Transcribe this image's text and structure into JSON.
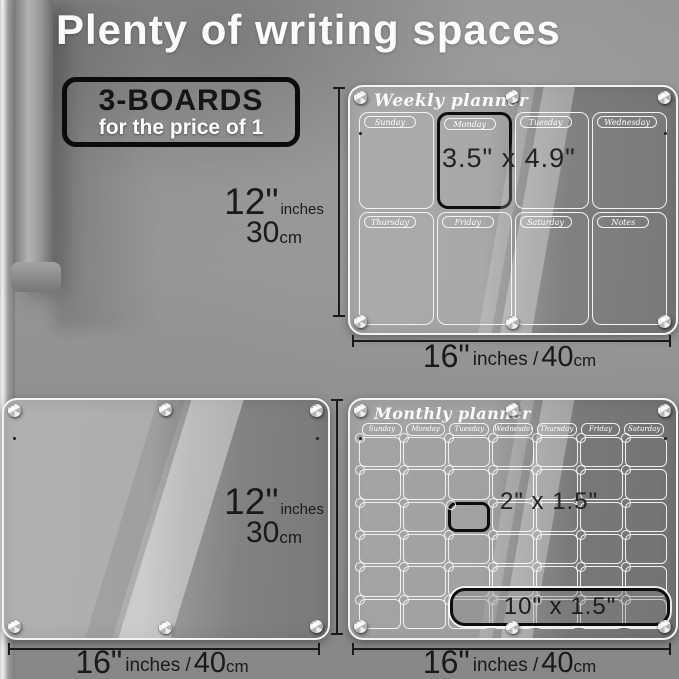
{
  "page": {
    "title": "Plenty of writing spaces"
  },
  "badge": {
    "line1": "3-BOARDS",
    "line2": "for the price of 1"
  },
  "colors": {
    "fridge_gray": "#8d8d8d",
    "board_light": "#a8a8a8",
    "board_dark": "#747474",
    "rim_white": "#f3f3f3",
    "highlight_black": "#0d0d0d",
    "dim_text": "#1a1a1a"
  },
  "weekly": {
    "title": "Weekly planner",
    "days": [
      "Sunday",
      "Monday",
      "Tuesday",
      "Wednesday",
      "Thursday",
      "Friday",
      "Saturday",
      "Notes"
    ],
    "highlighted_day": "Monday",
    "cell_size_label": "3.5\" x 4.9\"",
    "height_label": {
      "num": "12\"",
      "unit": "inches",
      "num2": "30",
      "unit2": "cm"
    },
    "width_label": {
      "num": "16\"",
      "unit": "inches /",
      "num2": "40",
      "unit2": "cm"
    }
  },
  "blank_board": {
    "height_label": {
      "num": "12\"",
      "unit": "inches",
      "num2": "30",
      "unit2": "cm"
    },
    "width_label": {
      "num": "16\"",
      "unit": "inches /",
      "num2": "40",
      "unit2": "cm"
    }
  },
  "monthly": {
    "title": "Monthly planner",
    "days": [
      "Sunday",
      "Monday",
      "Tuesday",
      "Wednesday",
      "Thursday",
      "Friday",
      "Saturday"
    ],
    "grid": {
      "rows": 6,
      "cols": 7
    },
    "highlight_cell": {
      "row": 3,
      "col": 3
    },
    "cell_size_label": "2\" x 1.5\"",
    "notes_size_label": "10\" x 1.5\"",
    "width_label": {
      "num": "16\"",
      "unit": "inches /",
      "num2": "40",
      "unit2": "cm"
    }
  }
}
